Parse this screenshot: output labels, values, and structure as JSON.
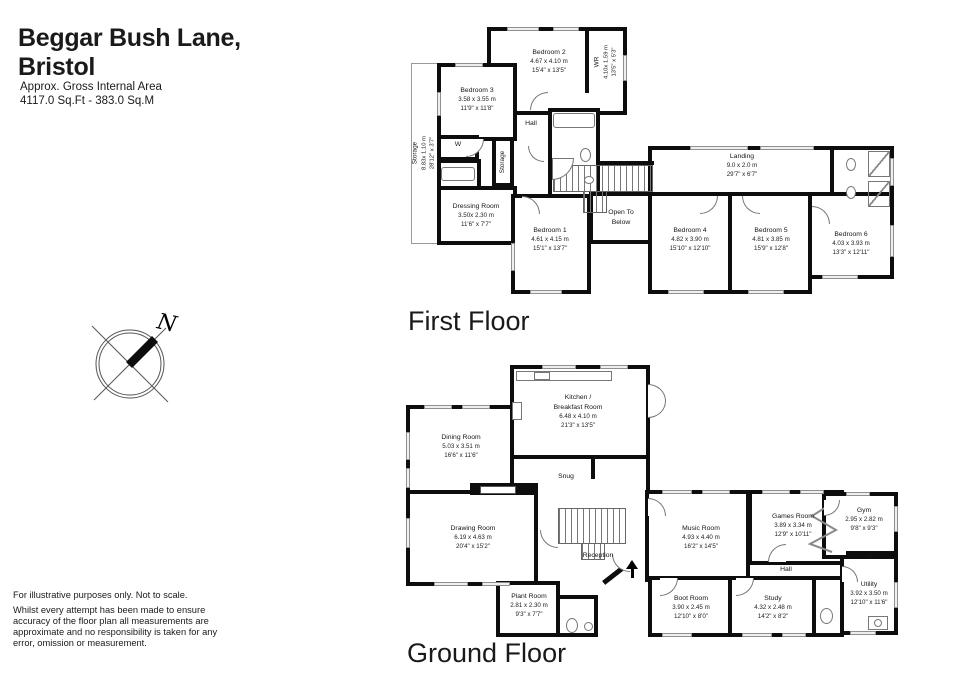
{
  "header": {
    "title_line1": "Beggar Bush Lane,",
    "title_line2": "Bristol",
    "subtitle_line1": "Approx. Gross Internal Area",
    "subtitle_line2": "4117.0 Sq.Ft - 383.0 Sq.M"
  },
  "compass": {
    "north_label": "N"
  },
  "first_floor": {
    "label": "First Floor",
    "rooms": {
      "bedroom2": {
        "name": "Bedroom 2",
        "metric": "4.67 x 4.10 m",
        "imperial": "15'4\" x 13'5\""
      },
      "wr": {
        "name": "WR",
        "metric": "4.10x 1.59 m",
        "imperial": "13'5\" x 5'3\""
      },
      "bedroom3": {
        "name": "Bedroom 3",
        "metric": "3.58 x 3.55 m",
        "imperial": "11'9\" x 11'8\""
      },
      "storage_eaves": {
        "name": "Storage",
        "metric": "8.83x 1.10 m",
        "imperial": "28'12\" x 3'7\""
      },
      "hall": {
        "name": "Hall"
      },
      "wardrobe": {
        "name": "W"
      },
      "storage_small": {
        "name": "Storage"
      },
      "dressing_room": {
        "name": "Dressing Room",
        "metric": "3.50x 2.30 m",
        "imperial": "11'6\" x 7'7\""
      },
      "bedroom1": {
        "name": "Bedroom 1",
        "metric": "4.61 x 4.15 m",
        "imperial": "15'1\" x 13'7\""
      },
      "open_to_below": {
        "line1": "Open To",
        "line2": "Below"
      },
      "landing": {
        "name": "Landing",
        "metric": "9.0 x 2.0 m",
        "imperial": "29'7\" x 6'7\""
      },
      "bedroom4": {
        "name": "Bedroom 4",
        "metric": "4.82 x 3.90 m",
        "imperial": "15'10\" x 12'10\""
      },
      "bedroom5": {
        "name": "Bedroom 5",
        "metric": "4.81 x 3.85 m",
        "imperial": "15'9\" x 12'8\""
      },
      "bedroom6": {
        "name": "Bedroom 6",
        "metric": "4.03 x 3.93 m",
        "imperial": "13'3\" x 12'11\""
      }
    }
  },
  "ground_floor": {
    "label": "Ground Floor",
    "rooms": {
      "kitchen": {
        "line1": "Kitchen /",
        "line2": "Breakfast Room",
        "metric": "6.48 x 4.10 m",
        "imperial": "21'3\" x 13'5\""
      },
      "dining_room": {
        "name": "Dining Room",
        "metric": "5.03 x 3.51 m",
        "imperial": "16'6\" x 11'6\""
      },
      "snug": {
        "name": "Snug"
      },
      "drawing_room": {
        "name": "Drawing Room",
        "metric": "6.19 x 4.63 m",
        "imperial": "20'4\" x 15'2\""
      },
      "reception": {
        "name": "Reception"
      },
      "music_room": {
        "name": "Music Room",
        "metric": "4.93 x 4.40 m",
        "imperial": "16'2\" x 14'5\""
      },
      "games_room": {
        "name": "Games Room",
        "metric": "3.89 x 3.34 m",
        "imperial": "12'9\" x 10'11\""
      },
      "gym": {
        "name": "Gym",
        "metric": "2.95 x 2.82 m",
        "imperial": "9'8\" x 9'3\""
      },
      "hall": {
        "name": "Hall"
      },
      "wardrobe": {
        "name": "W"
      },
      "plant_room": {
        "name": "Plant Room",
        "metric": "2.81 x 2.30 m",
        "imperial": "9'3\" x 7'7\""
      },
      "boot_room": {
        "name": "Boot Room",
        "metric": "3.90 x 2.45 m",
        "imperial": "12'10\" x 8'0\""
      },
      "study": {
        "name": "Study",
        "metric": "4.32 x 2.48 m",
        "imperial": "14'2\" x 8'2\""
      },
      "utility": {
        "name": "Utility",
        "metric": "3.92 x 3.50 m",
        "imperial": "12'10\" x 11'6\""
      }
    }
  },
  "footer": {
    "line1": "For illustrative purposes only. Not to scale.",
    "body": "Whilst every attempt has been made to ensure accuracy of the floor plan all measurements are approximate and no responsibility is taken for any error, omission or measurement."
  },
  "colors": {
    "wall": "#0d0d0d",
    "window_fill": "#efefef",
    "text": "#1a1a1a"
  }
}
